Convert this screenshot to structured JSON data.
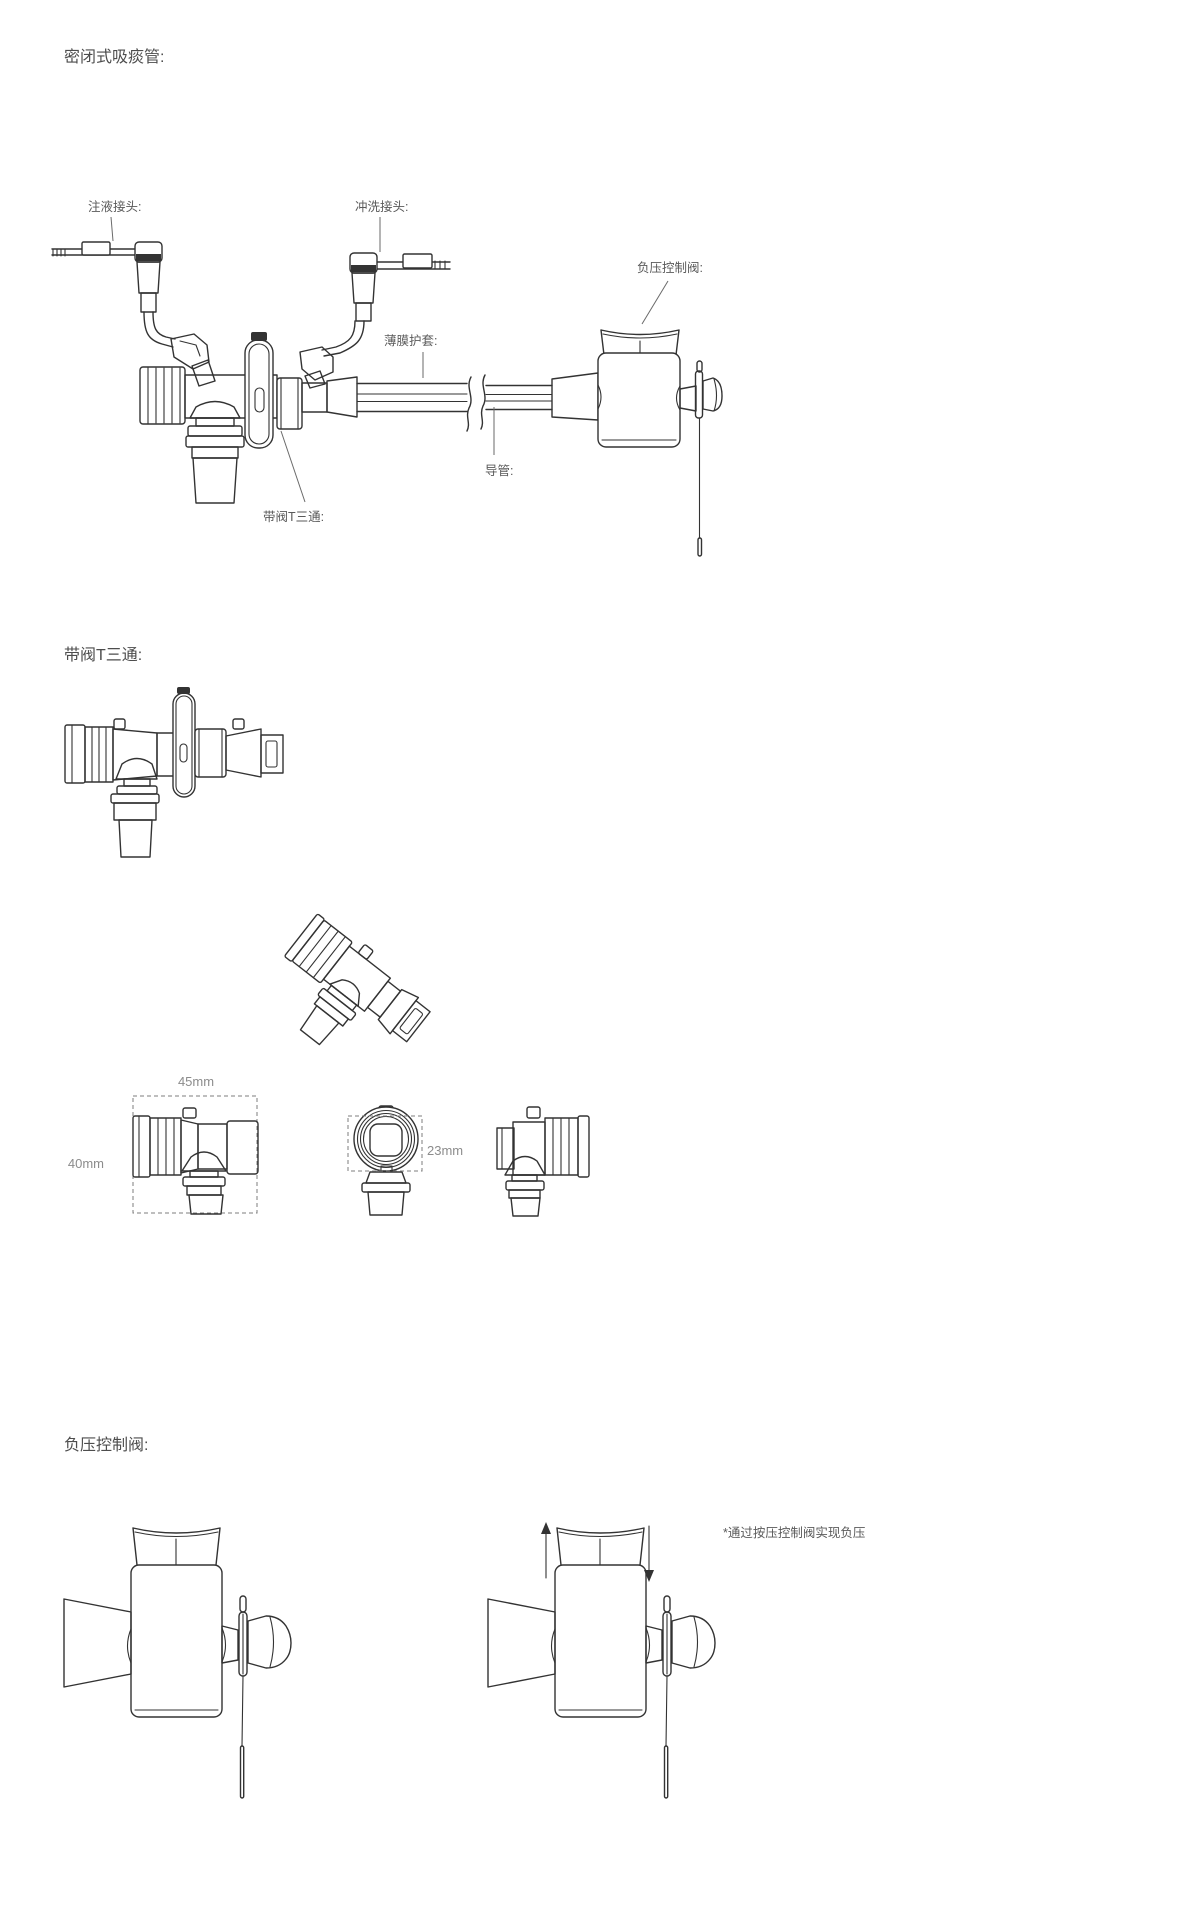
{
  "colors": {
    "line": "#333333",
    "label_text": "#5a5a5a",
    "dim_text": "#8c8c8c",
    "background": "#ffffff"
  },
  "sections": [
    {
      "title": "密闭式吸痰管:"
    },
    {
      "title": "带阀T三通:"
    },
    {
      "title": "负压控制阀:"
    }
  ],
  "assembly_labels": {
    "injection_port": "注液接头:",
    "flush_port": "冲洗接头:",
    "suction_valve": "负压控制阀:",
    "membrane_sleeve": "薄膜护套:",
    "catheter": "导管:",
    "valved_tee": "带阀T三通:"
  },
  "dimensions": {
    "width": "45mm",
    "height": "40mm",
    "diameter": "23mm"
  },
  "note": "*通过按压控制阀实现负压"
}
